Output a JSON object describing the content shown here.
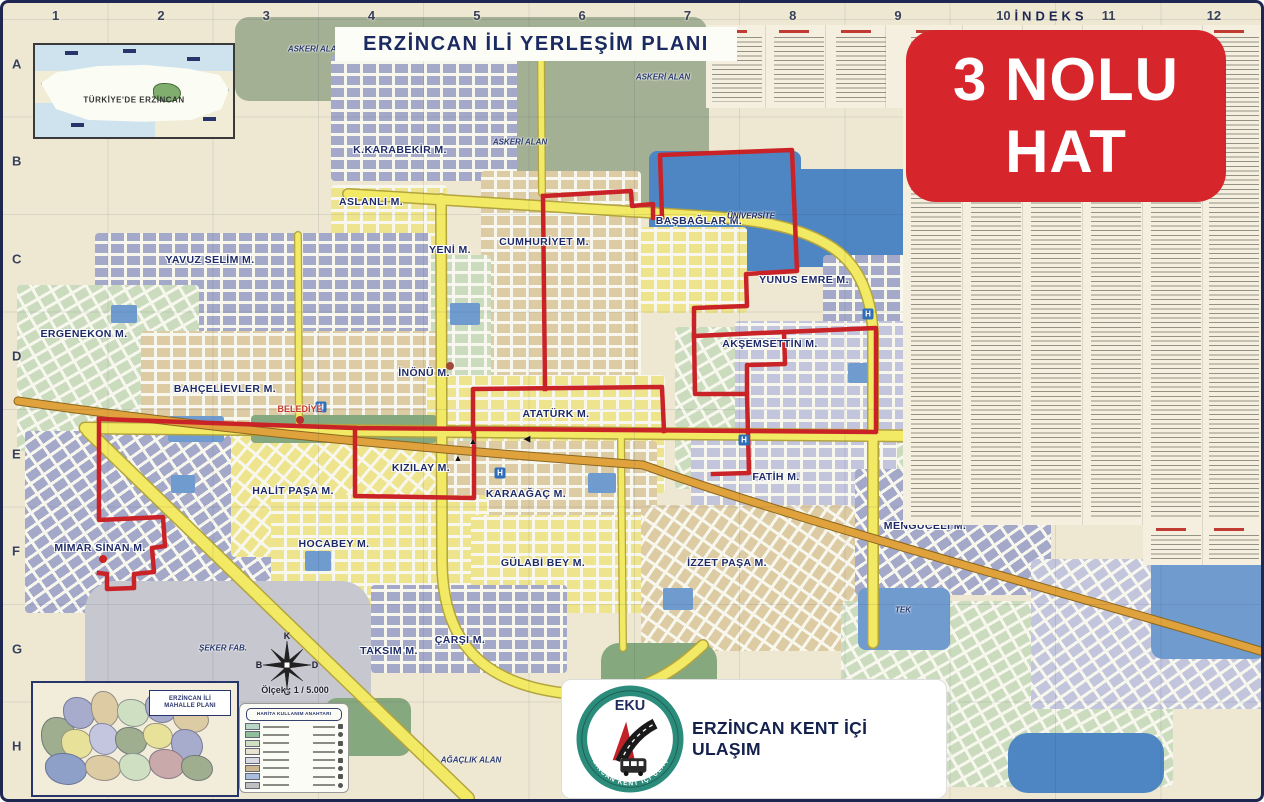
{
  "title": "ERZİNCAN İLİ YERLEŞİM PLANI",
  "badge": {
    "line1": "3 NOLU",
    "line2": "HAT",
    "color": "#d6262b"
  },
  "grid": {
    "index_label": "İNDEKS",
    "columns": [
      "1",
      "2",
      "3",
      "4",
      "5",
      "6",
      "7",
      "8",
      "9",
      "10",
      "11",
      "12"
    ],
    "rows": [
      "A",
      "B",
      "C",
      "D",
      "E",
      "F",
      "G",
      "H"
    ]
  },
  "insets": {
    "turkey": {
      "label": "TÜRKİYE'DE ERZİNCAN"
    },
    "mahalle": {
      "label_line1": "ERZİNCAN İLİ",
      "label_line2": "MAHALLE PLANI"
    }
  },
  "legend": {
    "title": "HARİTA KULLANIM ANAHTARI"
  },
  "scale": {
    "text": "Ölçek : 1 / 5.000"
  },
  "compass": {
    "north": "K",
    "east": "D",
    "south": "G",
    "west": "B"
  },
  "footer_logo": {
    "abbr": "EKU",
    "ring_text": "ERZİNCAN KENT İÇİ ULAŞIM",
    "org": "ERZİNCAN KENT İÇİ ULAŞIM"
  },
  "route": {
    "name": "3 NOLU HAT",
    "color": "#c92327"
  },
  "map_labels": {
    "neighborhoods": [
      {
        "name": "K.KARABEKİR M.",
        "x": 397,
        "y": 147
      },
      {
        "name": "ASLANLI M.",
        "x": 368,
        "y": 199
      },
      {
        "name": "YENİ M.",
        "x": 447,
        "y": 247
      },
      {
        "name": "CUMHURİYET M.",
        "x": 541,
        "y": 239
      },
      {
        "name": "YAVUZ SELİM M.",
        "x": 207,
        "y": 257
      },
      {
        "name": "BAŞBAĞLAR M.",
        "x": 696,
        "y": 218
      },
      {
        "name": "YUNUS EMRE M.",
        "x": 801,
        "y": 277
      },
      {
        "name": "ERGENEKON M.",
        "x": 81,
        "y": 331
      },
      {
        "name": "AKŞEMSETTİN M.",
        "x": 767,
        "y": 341
      },
      {
        "name": "BAHÇELİEVLER M.",
        "x": 222,
        "y": 386
      },
      {
        "name": "İNÖNÜ M.",
        "x": 421,
        "y": 370
      },
      {
        "name": "ATATÜRK M.",
        "x": 553,
        "y": 411
      },
      {
        "name": "KIZILAY M.",
        "x": 418,
        "y": 465
      },
      {
        "name": "FATİH M.",
        "x": 773,
        "y": 474
      },
      {
        "name": "HALİT PAŞA M.",
        "x": 290,
        "y": 488
      },
      {
        "name": "KARAAĞAÇ M.",
        "x": 523,
        "y": 491
      },
      {
        "name": "MENGÜCELİ M.",
        "x": 922,
        "y": 523
      },
      {
        "name": "MİMAR SİNAN M.",
        "x": 97,
        "y": 545
      },
      {
        "name": "HOCABEY M.",
        "x": 331,
        "y": 541
      },
      {
        "name": "GÜLABİ BEY M.",
        "x": 540,
        "y": 560
      },
      {
        "name": "İZZET PAŞA M.",
        "x": 724,
        "y": 560
      },
      {
        "name": "TAKSIM M.",
        "x": 386,
        "y": 648
      },
      {
        "name": "ÇARŞI M.",
        "x": 457,
        "y": 637
      }
    ],
    "places": [
      {
        "name": "BELEDİYE",
        "x": 297,
        "y": 406,
        "cls": "red"
      },
      {
        "name": "ÜNİVERSİTE",
        "x": 748,
        "y": 213,
        "cls": "blue-it"
      },
      {
        "name": "ASKERİ ALAN",
        "x": 312,
        "y": 46,
        "cls": "navy-it"
      },
      {
        "name": "ASKERİ ALAN",
        "x": 517,
        "y": 139,
        "cls": "navy-it"
      },
      {
        "name": "ASKERİ ALAN",
        "x": 660,
        "y": 74,
        "cls": "navy-it"
      },
      {
        "name": "ŞEKER FAB.",
        "x": 220,
        "y": 645,
        "cls": "navy-it"
      },
      {
        "name": "TEK",
        "x": 900,
        "y": 607,
        "cls": "navy-it"
      },
      {
        "name": "AĞAÇLIK ALAN",
        "x": 468,
        "y": 757,
        "cls": "navy-it"
      }
    ]
  },
  "map_icons": {
    "hospital_glyph": "H",
    "hospitals": [
      {
        "x": 318,
        "y": 404
      },
      {
        "x": 497,
        "y": 470
      },
      {
        "x": 741,
        "y": 437
      },
      {
        "x": 865,
        "y": 311
      }
    ],
    "dots": [
      {
        "x": 297,
        "y": 417,
        "c": "#b8312f"
      },
      {
        "x": 447,
        "y": 363,
        "c": "#a14a3a"
      },
      {
        "x": 100,
        "y": 556,
        "c": "#cc2222"
      }
    ],
    "arrows": [
      {
        "x": 470,
        "y": 438,
        "g": "▲"
      },
      {
        "x": 455,
        "y": 455,
        "g": "▲"
      },
      {
        "x": 524,
        "y": 436,
        "g": "◀"
      }
    ]
  },
  "colors": {
    "accent_navy": "#1d2752",
    "route_red": "#c92327",
    "road_yellow": "#f2e964",
    "highway_orange": "#dfa23c"
  }
}
